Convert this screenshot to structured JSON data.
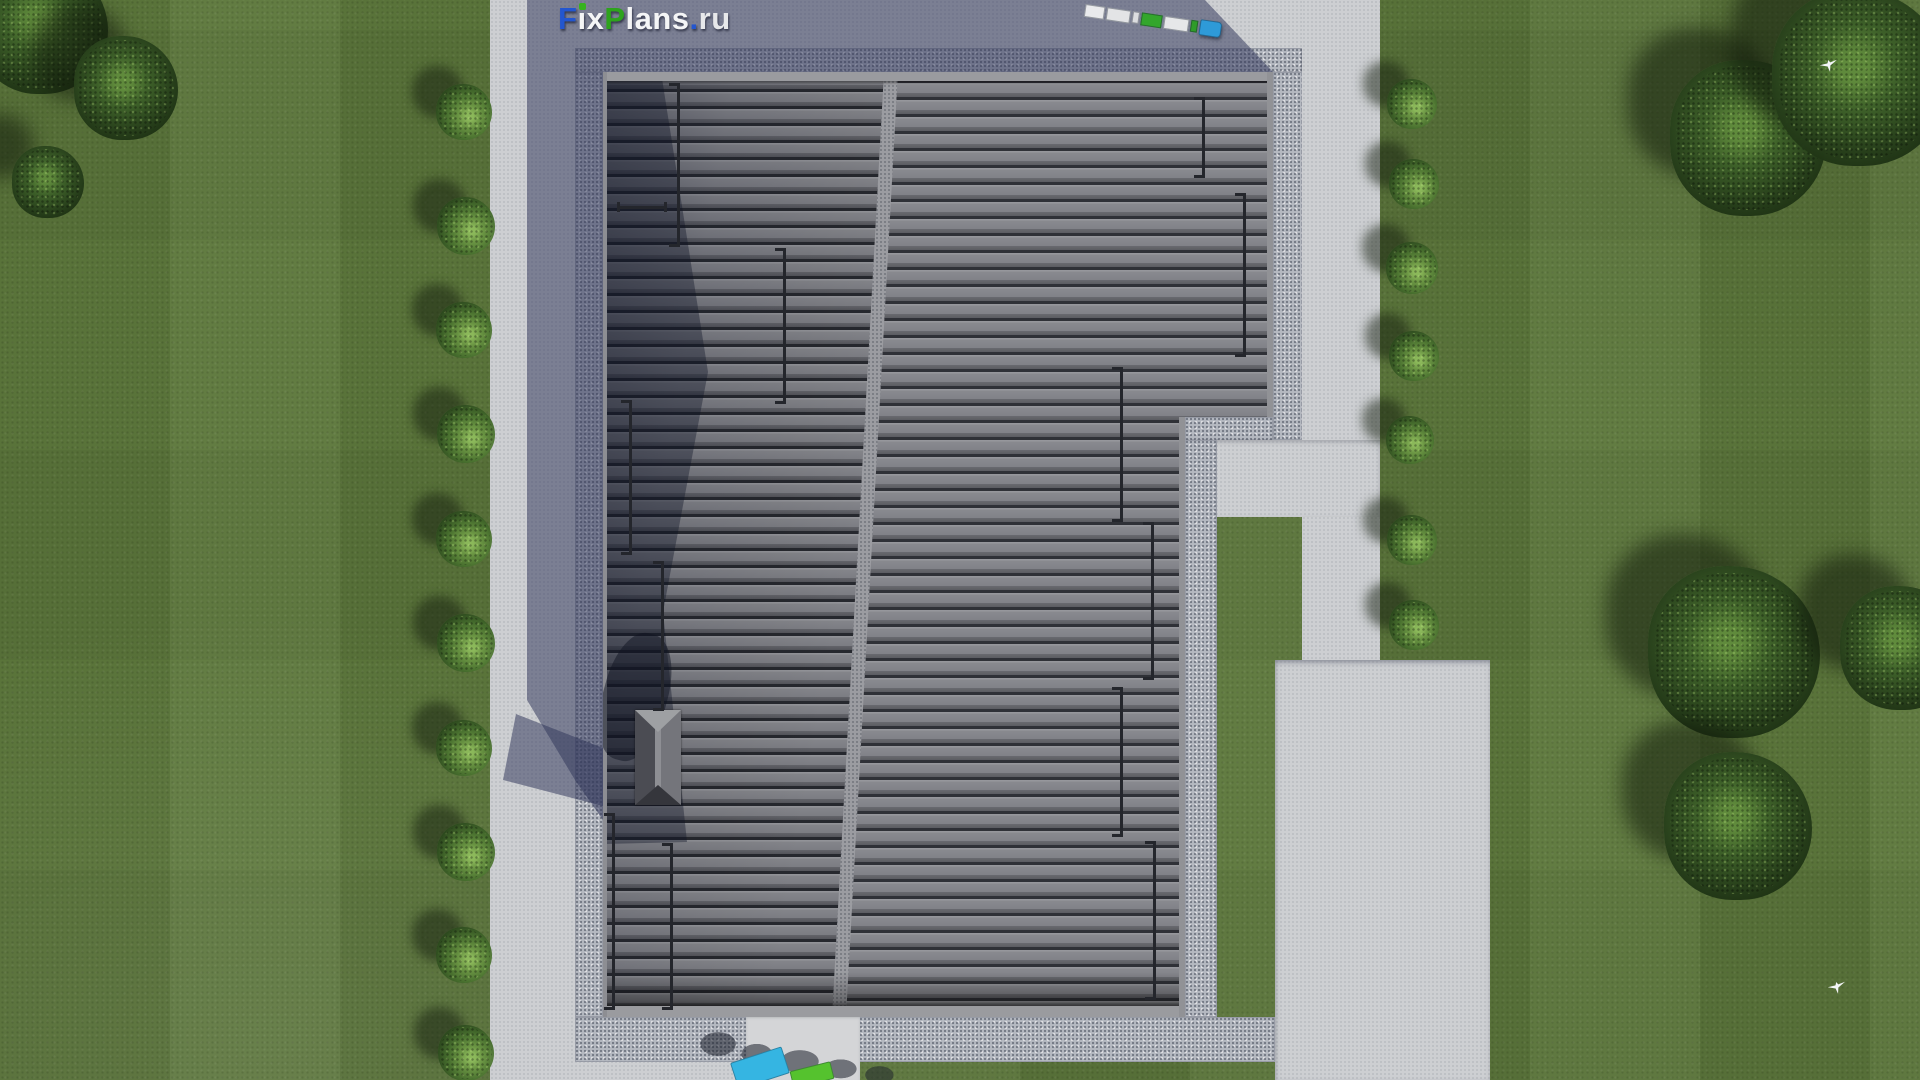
{
  "meta": {
    "brand": "FixPlans.ru"
  },
  "logo": {
    "segments": [
      {
        "text": "F",
        "color": "#2356cf"
      },
      {
        "text": "ı",
        "color": "#f4f5f6",
        "dot": true
      },
      {
        "text": "x",
        "color": "#f4f5f6"
      },
      {
        "text": "P",
        "color": "#2ea31d"
      },
      {
        "text": "lans",
        "color": "#f4f5f6"
      },
      {
        "text": ".",
        "color": "#2356cf"
      },
      {
        "text": "ru",
        "color": "#e7e8ea"
      }
    ]
  },
  "palette": {
    "lawn": "#5d783c",
    "concrete": "#cdcfd2",
    "gravel": "#b5b9c1",
    "pavement_shadow": "#5a6078",
    "roof_tile_face": "#83848a",
    "roof_tile_gap": "#26282e",
    "roof_ridge": "#9b9ca1",
    "logo_blue": "#2356cf",
    "logo_green": "#2ea31d",
    "truck_cab_blue": "#2e9ad8",
    "truck_cargo_green": "#33a62c",
    "object_cyan": "#35b5e2",
    "object_green": "#55c22e"
  },
  "scene": {
    "bushes": [
      {
        "x": 464,
        "y": 112,
        "r": 28
      },
      {
        "x": 466,
        "y": 226,
        "r": 29
      },
      {
        "x": 464,
        "y": 330,
        "r": 28
      },
      {
        "x": 466,
        "y": 434,
        "r": 29
      },
      {
        "x": 464,
        "y": 539,
        "r": 28
      },
      {
        "x": 466,
        "y": 643,
        "r": 29
      },
      {
        "x": 464,
        "y": 748,
        "r": 28
      },
      {
        "x": 466,
        "y": 852,
        "r": 29
      },
      {
        "x": 464,
        "y": 955,
        "r": 28
      },
      {
        "x": 466,
        "y": 1053,
        "r": 28
      },
      {
        "x": 1412,
        "y": 104,
        "r": 25
      },
      {
        "x": 1414,
        "y": 184,
        "r": 25
      },
      {
        "x": 1412,
        "y": 268,
        "r": 26
      },
      {
        "x": 1414,
        "y": 356,
        "r": 25
      },
      {
        "x": 1410,
        "y": 440,
        "r": 24
      },
      {
        "x": 1412,
        "y": 540,
        "r": 25
      },
      {
        "x": 1414,
        "y": 625,
        "r": 25
      }
    ],
    "trees": [
      {
        "x": 42,
        "y": 28,
        "r": 66
      },
      {
        "x": 126,
        "y": 88,
        "r": 52
      },
      {
        "x": 48,
        "y": 182,
        "r": 36
      },
      {
        "x": 1748,
        "y": 138,
        "r": 78
      },
      {
        "x": 1860,
        "y": 78,
        "r": 88
      },
      {
        "x": 1734,
        "y": 652,
        "r": 86
      },
      {
        "x": 1738,
        "y": 826,
        "r": 74
      },
      {
        "x": 1902,
        "y": 648,
        "r": 62
      }
    ],
    "birds": [
      {
        "x": 1820,
        "y": 60
      },
      {
        "x": 1828,
        "y": 982
      }
    ],
    "roof_rails": [
      {
        "o": "v",
        "x": 74,
        "y": 11,
        "len": 164
      },
      {
        "o": "h",
        "x": 14,
        "y": 134,
        "len": 50
      },
      {
        "o": "v",
        "x": 180,
        "y": 176,
        "len": 156
      },
      {
        "o": "v",
        "x": 26,
        "y": 328,
        "len": 155
      },
      {
        "o": "v",
        "x": 58,
        "y": 489,
        "len": 150
      },
      {
        "o": "v",
        "x": 9,
        "y": 741,
        "len": 197
      },
      {
        "o": "v",
        "x": 67,
        "y": 771,
        "len": 167
      },
      {
        "o": "v",
        "x": 599,
        "y": 25,
        "len": 81
      },
      {
        "o": "v",
        "x": 640,
        "y": 121,
        "len": 164
      },
      {
        "o": "v",
        "x": 517,
        "y": 295,
        "len": 155
      },
      {
        "o": "v",
        "x": 548,
        "y": 450,
        "len": 158
      },
      {
        "o": "v",
        "x": 517,
        "y": 615,
        "len": 150
      },
      {
        "o": "v",
        "x": 550,
        "y": 769,
        "len": 159
      }
    ],
    "truck": {
      "x": 1086,
      "y": 2,
      "angle": 8.5,
      "segments": [
        {
          "w": 20,
          "h": 13,
          "c": "#e9eaec"
        },
        {
          "w": 24,
          "h": 13,
          "c": "#e3e4e6"
        },
        {
          "w": 7,
          "h": 12,
          "c": "#dcdde0"
        },
        {
          "w": 21,
          "h": 13,
          "c": "#33a62c"
        },
        {
          "w": 25,
          "h": 13,
          "c": "#e6e7e9"
        },
        {
          "w": 7,
          "h": 12,
          "c": "#2f9c28"
        },
        {
          "w": 22,
          "h": 16,
          "c": "#2e9ad8"
        }
      ]
    },
    "ground_objects": [
      {
        "x": 733,
        "y": 1054,
        "w": 54,
        "h": 28,
        "angle": -18,
        "c": "#35b5e2"
      },
      {
        "x": 791,
        "y": 1066,
        "w": 42,
        "h": 18,
        "angle": -14,
        "c": "#55c22e"
      }
    ]
  }
}
